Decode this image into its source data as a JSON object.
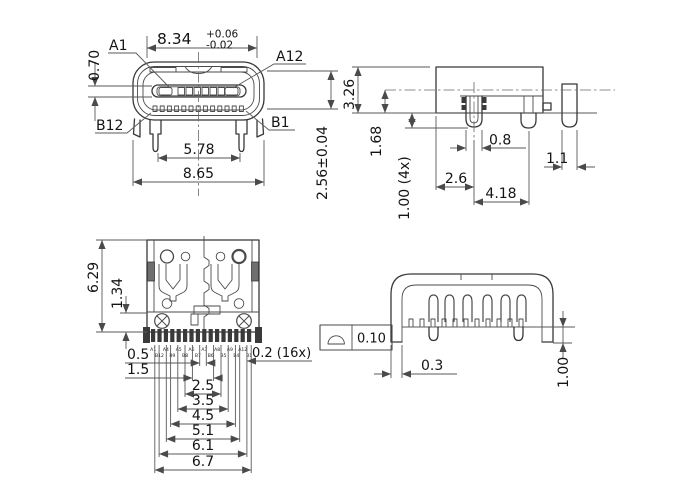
{
  "drawing_type": "connector-mechanical-drawing",
  "front_view": {
    "dim_shell_width": "8.34",
    "dim_shell_width_tol_upper": "+0.06",
    "dim_shell_width_tol_lower": "-0.02",
    "pin_a1": "A1",
    "pin_a12": "A12",
    "pin_b12": "B12",
    "pin_b1": "B1",
    "dim_tongue_offset": "0.70",
    "dim_leg_span": "5.78",
    "dim_overall_width": "8.65",
    "dim_opening_height": "2.56±0.04"
  },
  "side_view": {
    "dim_body_height": "3.26",
    "dim_center_to_base": "1.68",
    "dim_leg_protrusion": "1.00 (4x)",
    "dim_front_leg_width": "0.8",
    "dim_side_leg_width": "1.1",
    "dim_edge_to_leg": "2.6",
    "dim_leg_pitch": "4.18"
  },
  "plan_view": {
    "dim_body_length": "6.29",
    "dim_solder_zone": "1.34",
    "pitch_dims": [
      "0.5",
      "1.5",
      "2.5",
      "3.5",
      "4.5",
      "5.1",
      "6.1",
      "6.7"
    ],
    "dim_pin_width": "0.2 (16x)",
    "pin_labels_row1": [
      "A1",
      "A4",
      "A5",
      "A6",
      "A7",
      "A8",
      "A9",
      "A12"
    ],
    "pin_labels_row2": [
      "B12",
      "B9",
      "B8",
      "B7",
      "B6",
      "B5",
      "B4",
      "B1"
    ]
  },
  "rear_view": {
    "gdt_symbol_name": "profile-of-a-surface",
    "gdt_tolerance": "0.10",
    "dim_shell_leg_width": "0.3",
    "dim_leg_below_seating": "1.00"
  },
  "colors": {
    "line": "#383838",
    "dim_line": "#5a5a5a",
    "text": "#141414",
    "background": "#ffffff"
  }
}
